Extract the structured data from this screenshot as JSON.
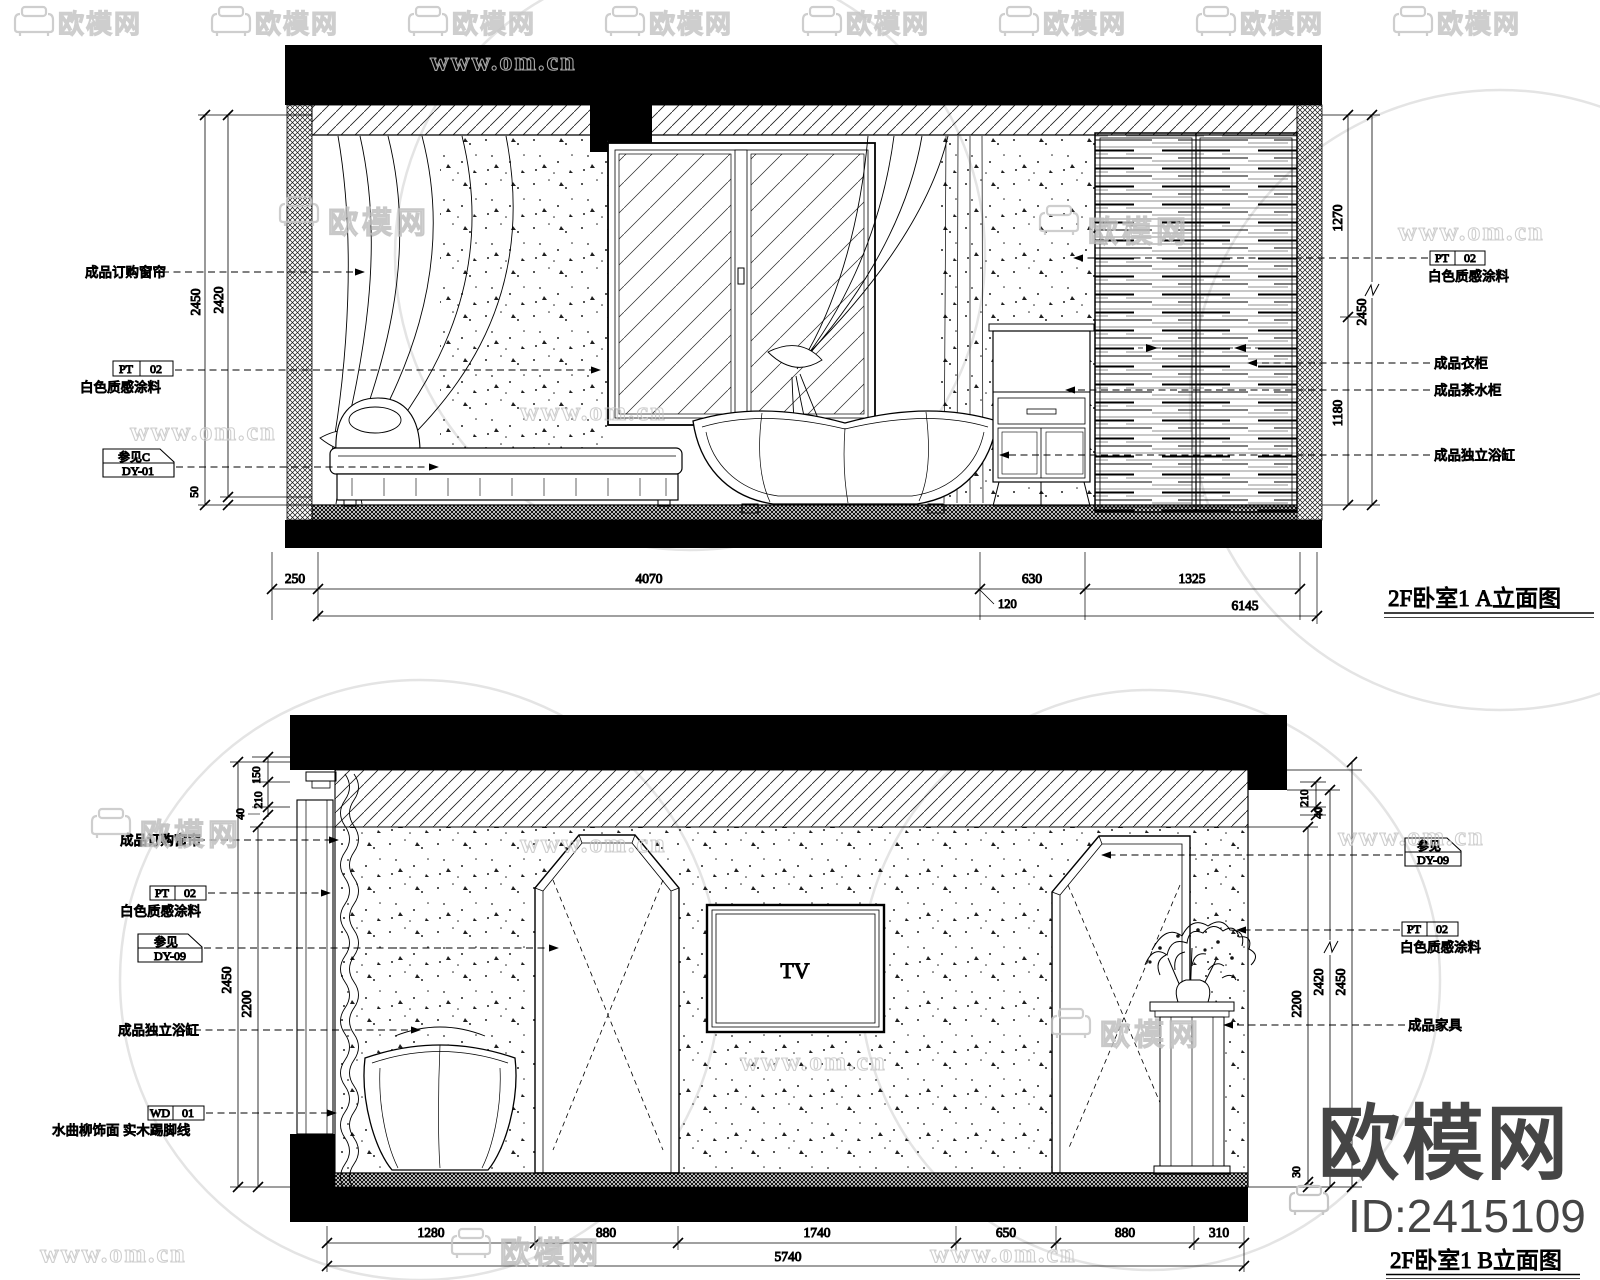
{
  "watermark": {
    "brand": "欧模网",
    "url": "www.om.cn",
    "id": "ID:2415109"
  },
  "materials": {
    "pt_code": "PT",
    "pt_num": "02",
    "pt_desc": "白色质感涂料",
    "wd_code": "WD",
    "wd_num": "01",
    "wd_desc": "水曲柳饰面  实木踢脚线"
  },
  "refs": {
    "see_c": "参见C",
    "dy01": "DY-01",
    "see": "参见",
    "dy09": "DY-09"
  },
  "elevation_a": {
    "title": "2F卧室1  A立面图",
    "labels": {
      "curtain": "成品订购窗帘",
      "wardrobe": "成品衣柜",
      "tea_cabinet": "成品茶水柜",
      "bathtub": "成品独立浴缸"
    },
    "dims": {
      "h2450": "2450",
      "h2420": "2420",
      "h50": "50",
      "h1270": "1270",
      "h1180": "1180",
      "hr2450": "2450",
      "w250": "250",
      "w4070": "4070",
      "w630": "630",
      "w1325": "1325",
      "w120": "120",
      "w6145": "6145"
    }
  },
  "elevation_b": {
    "title": "2F卧室1  B立面图",
    "labels": {
      "curtain": "成品订购窗帘",
      "bathtub": "成品独立浴缸",
      "furniture": "成品家具",
      "tv": "TV"
    },
    "dims": {
      "l150": "150",
      "l210": "210",
      "l40": "40",
      "l2450": "2450",
      "l2200": "2200",
      "r210": "210",
      "r40": "40",
      "r2200": "2200",
      "r2420": "2420",
      "r2450": "2450",
      "r30": "30",
      "w1280": "1280",
      "w880a": "880",
      "w1740": "1740",
      "w650": "650",
      "w880b": "880",
      "w310": "310",
      "w5740": "5740"
    }
  }
}
